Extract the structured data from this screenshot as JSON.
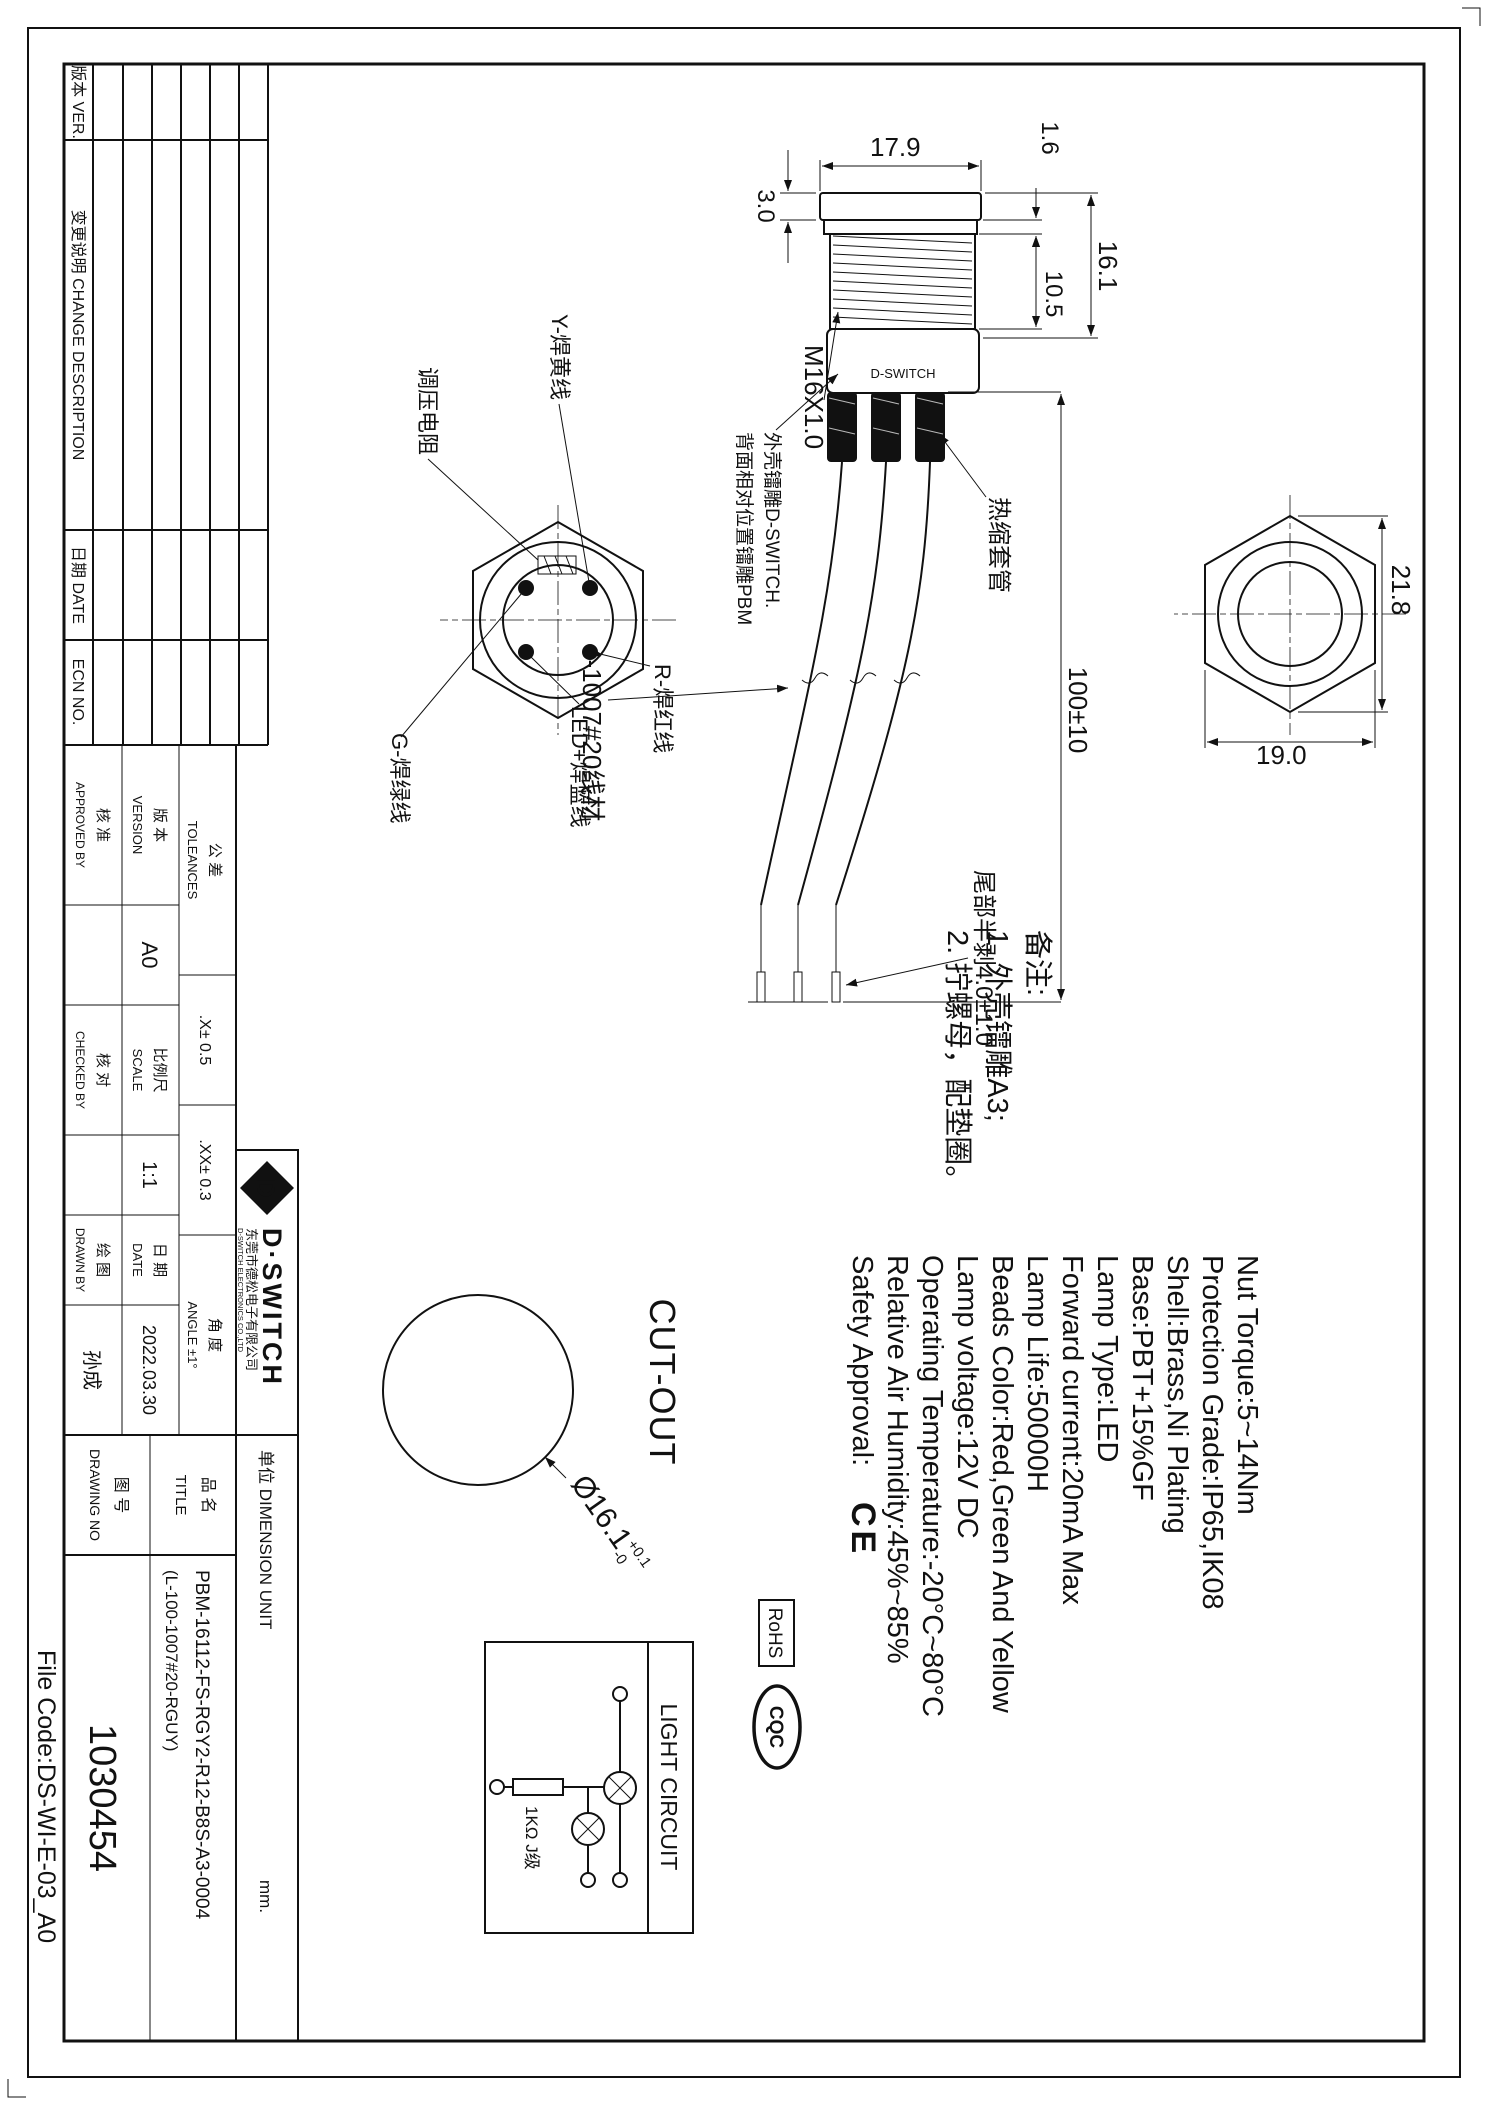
{
  "page": {
    "file_code": "File Code:DS-WI-E-03_A0"
  },
  "rev": {
    "h_ver": "版本 VER.",
    "h_desc": "变更说明 CHANGE DESCRIPTION",
    "h_date": "日期 DATE",
    "h_ecn": "ECN NO."
  },
  "tb": {
    "tol_zh": "公 差",
    "tol_en": "TOLEANCES",
    "x": ".X± 0.5",
    "xx": ".XX± 0.3",
    "ang_zh": "角 度",
    "ang_en": "ANGLE ±1°",
    "ver_zh": "版 本",
    "ver_en": "VERSION",
    "ver_val": "A0",
    "scale_zh": "比例尺",
    "scale_en": "SCALE",
    "scale_val": "1:1",
    "date_zh": "日 期",
    "date_en": "DATE",
    "date_val": "2022.03.30",
    "app_zh": "核 准",
    "app_en": "APPROVED BY",
    "chk_zh": "核 对",
    "chk_en": "CHECKED BY",
    "drw_zh": "绘 图",
    "drw_en": "DRAWN BY",
    "drw_val": "孙成",
    "brand_d": "D",
    "brand": "D·SWITCH",
    "co_zh": "东莞市德松电子有限公司",
    "co_en": "D-SWITCH ELECTRONICS CO.,LTD",
    "unit_label": "单位 DIMENSION UNIT",
    "unit_val": "mm.",
    "pn_zh": "品 名",
    "pn_en": "TITLE",
    "pn1": "PBM-16112-FS-RGY2-R12-B8S-A3-0004",
    "pn2": "(L-100-1007#20-RGUY)",
    "no_zh": "图 号",
    "no_en": "DRAWING NO",
    "no_val": "1030454"
  },
  "specs": [
    "Nut Torque:5~14Nm",
    "Protection Grade:IP65,IK08",
    "Shell:Brass,Ni Plating",
    "Base:PBT+15%GF",
    "Lamp Type:LED",
    "Forward current:20mA Max",
    "Lamp Life:50000H",
    "Beads Color:Red,Green And Yellow",
    "Lamp voltage:12V DC",
    "Operating Temperature:-20°C~80°C",
    "Relative Air Humidity:45%~85%",
    "Safety Approval:"
  ],
  "certs": {
    "ce": "CE",
    "rohs": "RoHS",
    "cqc": "CQC"
  },
  "notes": {
    "t": "备注:",
    "l1": "1. 外壳镭雕A3;",
    "l2": "2. 拧螺母，配垫圈。"
  },
  "dims": {
    "d179": "17.9",
    "d30": "3.0",
    "d16": "1.6",
    "d161": "16.1",
    "d105": "10.5",
    "thread": "M16X1.0",
    "len": "100±10",
    "d218": "21.8",
    "d190": "19.0",
    "tail": "尾部半剥4.0±1.0",
    "wire": "4-1007#20线材",
    "heat": "热缩套管",
    "shell_mark": "D-SWITCH",
    "laser1": "外壳镭雕D-SWITCH.",
    "laser2": "背面相对位置镭雕PBM",
    "cut": "CUT-OUT",
    "cut_d": "Ø16.1",
    "cut_tp": "+0.1",
    "cut_tm": "-0"
  },
  "wl": {
    "y": "Y-焊黄线",
    "r": "R-焊红线",
    "b": "LED+焊蓝线",
    "g": "G-焊绿线",
    "res": "调压电阻"
  },
  "lc": {
    "title": "LIGHT CIRCUIT",
    "res": "1KΩ J级"
  }
}
